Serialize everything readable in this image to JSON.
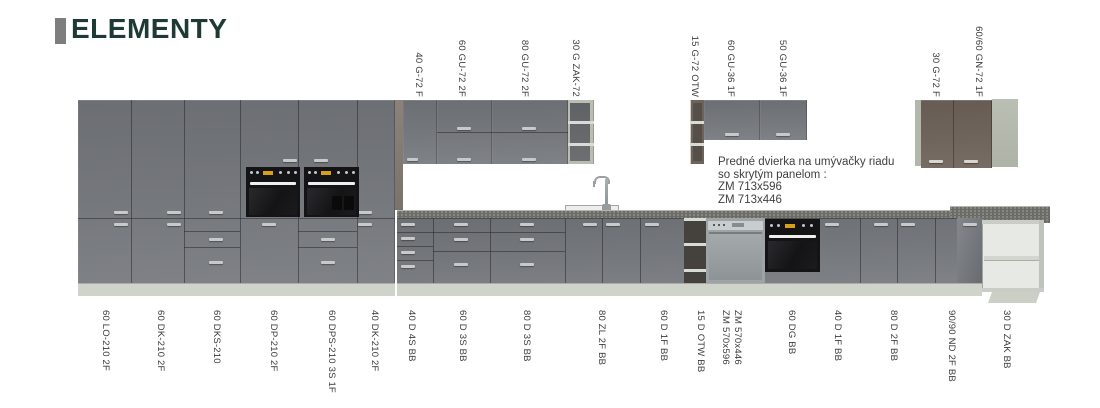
{
  "page": {
    "title": "ELEMENTY"
  },
  "colors": {
    "title_text": "#1d3a34",
    "title_accent_bar": "#7e7e7e",
    "cabinet_gray": "#75787c",
    "cabinet_taupe": "#6f645b",
    "carcass_light": "#b4b9ad",
    "counter": "#6b6b67",
    "plinth": "#cfd3ca",
    "label_text": "#3b3b3b"
  },
  "note": {
    "line1": "Predné dvierka na umývačky riadu",
    "line2": "so skrytým panelom :",
    "line3": "ZM 713x596",
    "line4": "ZM 713x446"
  },
  "top_labels": [
    {
      "text": "40 G-72 F"
    },
    {
      "text": "60 GU-72 2F"
    },
    {
      "text": "80 GU-72 2F"
    },
    {
      "text": "30 G ZAK-72"
    },
    {
      "text": "15 G-72 OTW"
    },
    {
      "text": "60 GU-36 1F"
    },
    {
      "text": "50 GU-36 1F"
    },
    {
      "text": "30 G-72 F"
    },
    {
      "text": "60/60 GN-72 1F"
    }
  ],
  "bottom_labels": [
    {
      "text": "60 LO-210 2F"
    },
    {
      "text": "60 DK-210 2F"
    },
    {
      "text": "60 DKS-210"
    },
    {
      "text": "60 DP-210 2F"
    },
    {
      "text": "60 DPS-210 3S 1F"
    },
    {
      "text": "40 DK-210 2F"
    },
    {
      "text": "40 D 4S BB"
    },
    {
      "text": "60 D 3S BB"
    },
    {
      "text": "80 D 3S BB"
    },
    {
      "text": "80 ZL 2F BB"
    },
    {
      "text": "60 D 1F BB"
    },
    {
      "text": "15 D OTW BB"
    },
    {
      "text": "ZM 570x596"
    },
    {
      "text": "ZM 570x446"
    },
    {
      "text": "60 DG BB"
    },
    {
      "text": "40 D 1F BB"
    },
    {
      "text": "80 D 2F BB"
    },
    {
      "text": "90/90 ND 2F BB"
    },
    {
      "text": "30 D ZAK BB"
    }
  ]
}
